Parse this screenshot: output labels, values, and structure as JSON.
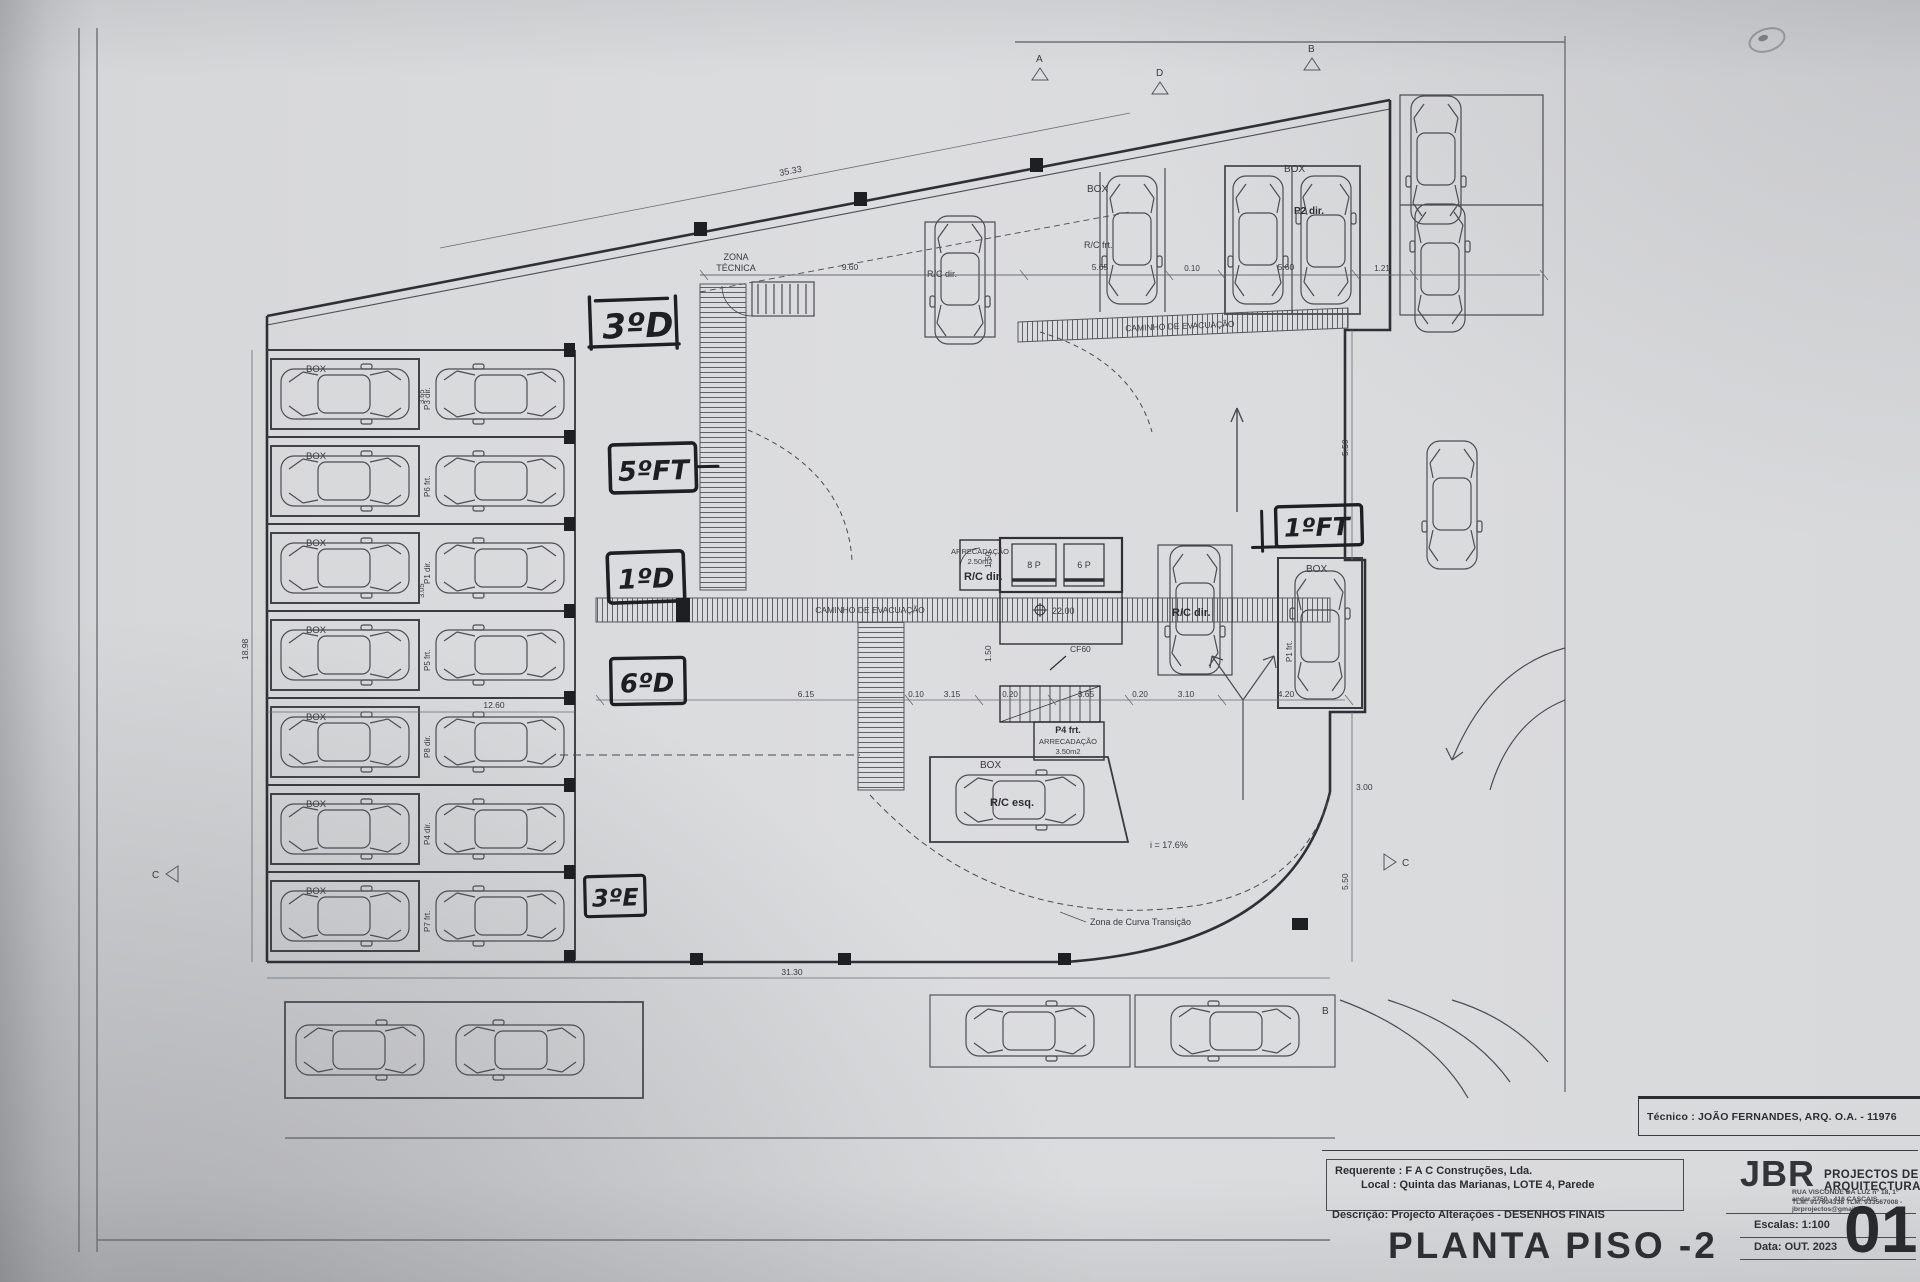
{
  "title_block": {
    "tecnico_line": "Técnico : JOÃO FERNANDES, ARQ.  O.A. - 11976",
    "logo": "JBR",
    "firm_name": "PROJECTOS DE ARQUITECTURA",
    "firm_address": "RUA VISCONDE DA LUZ nº 18, 1º andar  2750 - 416  CASCAIS",
    "firm_contacts": "TLM: 917604338  TLM: 933567008 - jbrprojectos@gmail.com",
    "requerente_label": "Requerente :",
    "requerente_value": "F A C  Construções, Lda.",
    "local_label": "Local :",
    "local_value": "Quinta das Marianas, LOTE 4, Parede",
    "descricao_label": "Descrição:",
    "descricao_value": "Projecto Alterações - DESENHOS FINAIS",
    "drawing_title": "PLANTA PISO -2",
    "escalas_label": "Escalas:",
    "escalas_value": "1:100",
    "data_label": "Data:",
    "data_value": "OUT. 2023",
    "sheet_number": "01"
  },
  "handwritten": {
    "a1": "3ºD",
    "a2": "5ºFT",
    "a3": "1ºD",
    "a4": "6ºD",
    "a5": "3ºE",
    "a6": "1ºFT"
  },
  "plan": {
    "zona_tecnica_line1": "ZONA",
    "zona_tecnica_line2": "TÉCNICA",
    "caminho_evacuacao": "CAMINHO DE EVACUAÇÃO",
    "box": "BOX",
    "stall_labels": {
      "p3": "P3 dir.",
      "p6": "P6 frt.",
      "p1": "P1 dir.",
      "p5": "P5 frt.",
      "p8": "P8 dir.",
      "p4": "P4 dir.",
      "p7": "P7 frt.",
      "p2_dir": "P2 dir.",
      "p1_frt": "P1 frt."
    },
    "unit_labels": {
      "rc_frt": "R/C frt.",
      "rc_dir": "R/C dir.",
      "rc_esq": "R/C esq."
    },
    "core": {
      "lift_a": "8 P",
      "lift_b": "6 P",
      "level": "22.00",
      "door": "CF60",
      "p4_frt": "P4 frt.",
      "arrecadacao": "ARRECADAÇÃO",
      "area_small": "2.50m2",
      "area_large": "3.50m2"
    },
    "ramp_slope": "i = 17.6%",
    "curve_zone": "Zona de Curva Transição",
    "dims": {
      "top_slant": "35.33",
      "w960": "9.60",
      "w565": "5.65",
      "w010": "0.10",
      "w560": "5.60",
      "w121": "1.21",
      "w615": "6.15",
      "w315": "3.15",
      "w020": "0.20",
      "w365": "3.65",
      "w310": "3.10",
      "w420": "4.20",
      "h150": "1.50",
      "h550": "5.50",
      "w300": "3.00",
      "w1260": "12.60",
      "w3130": "31.30",
      "h1898": "18.98",
      "h365": "3.65",
      "h305": "3.05"
    },
    "markers": {
      "a": "A",
      "d": "D",
      "b": "B",
      "c": "C"
    }
  }
}
